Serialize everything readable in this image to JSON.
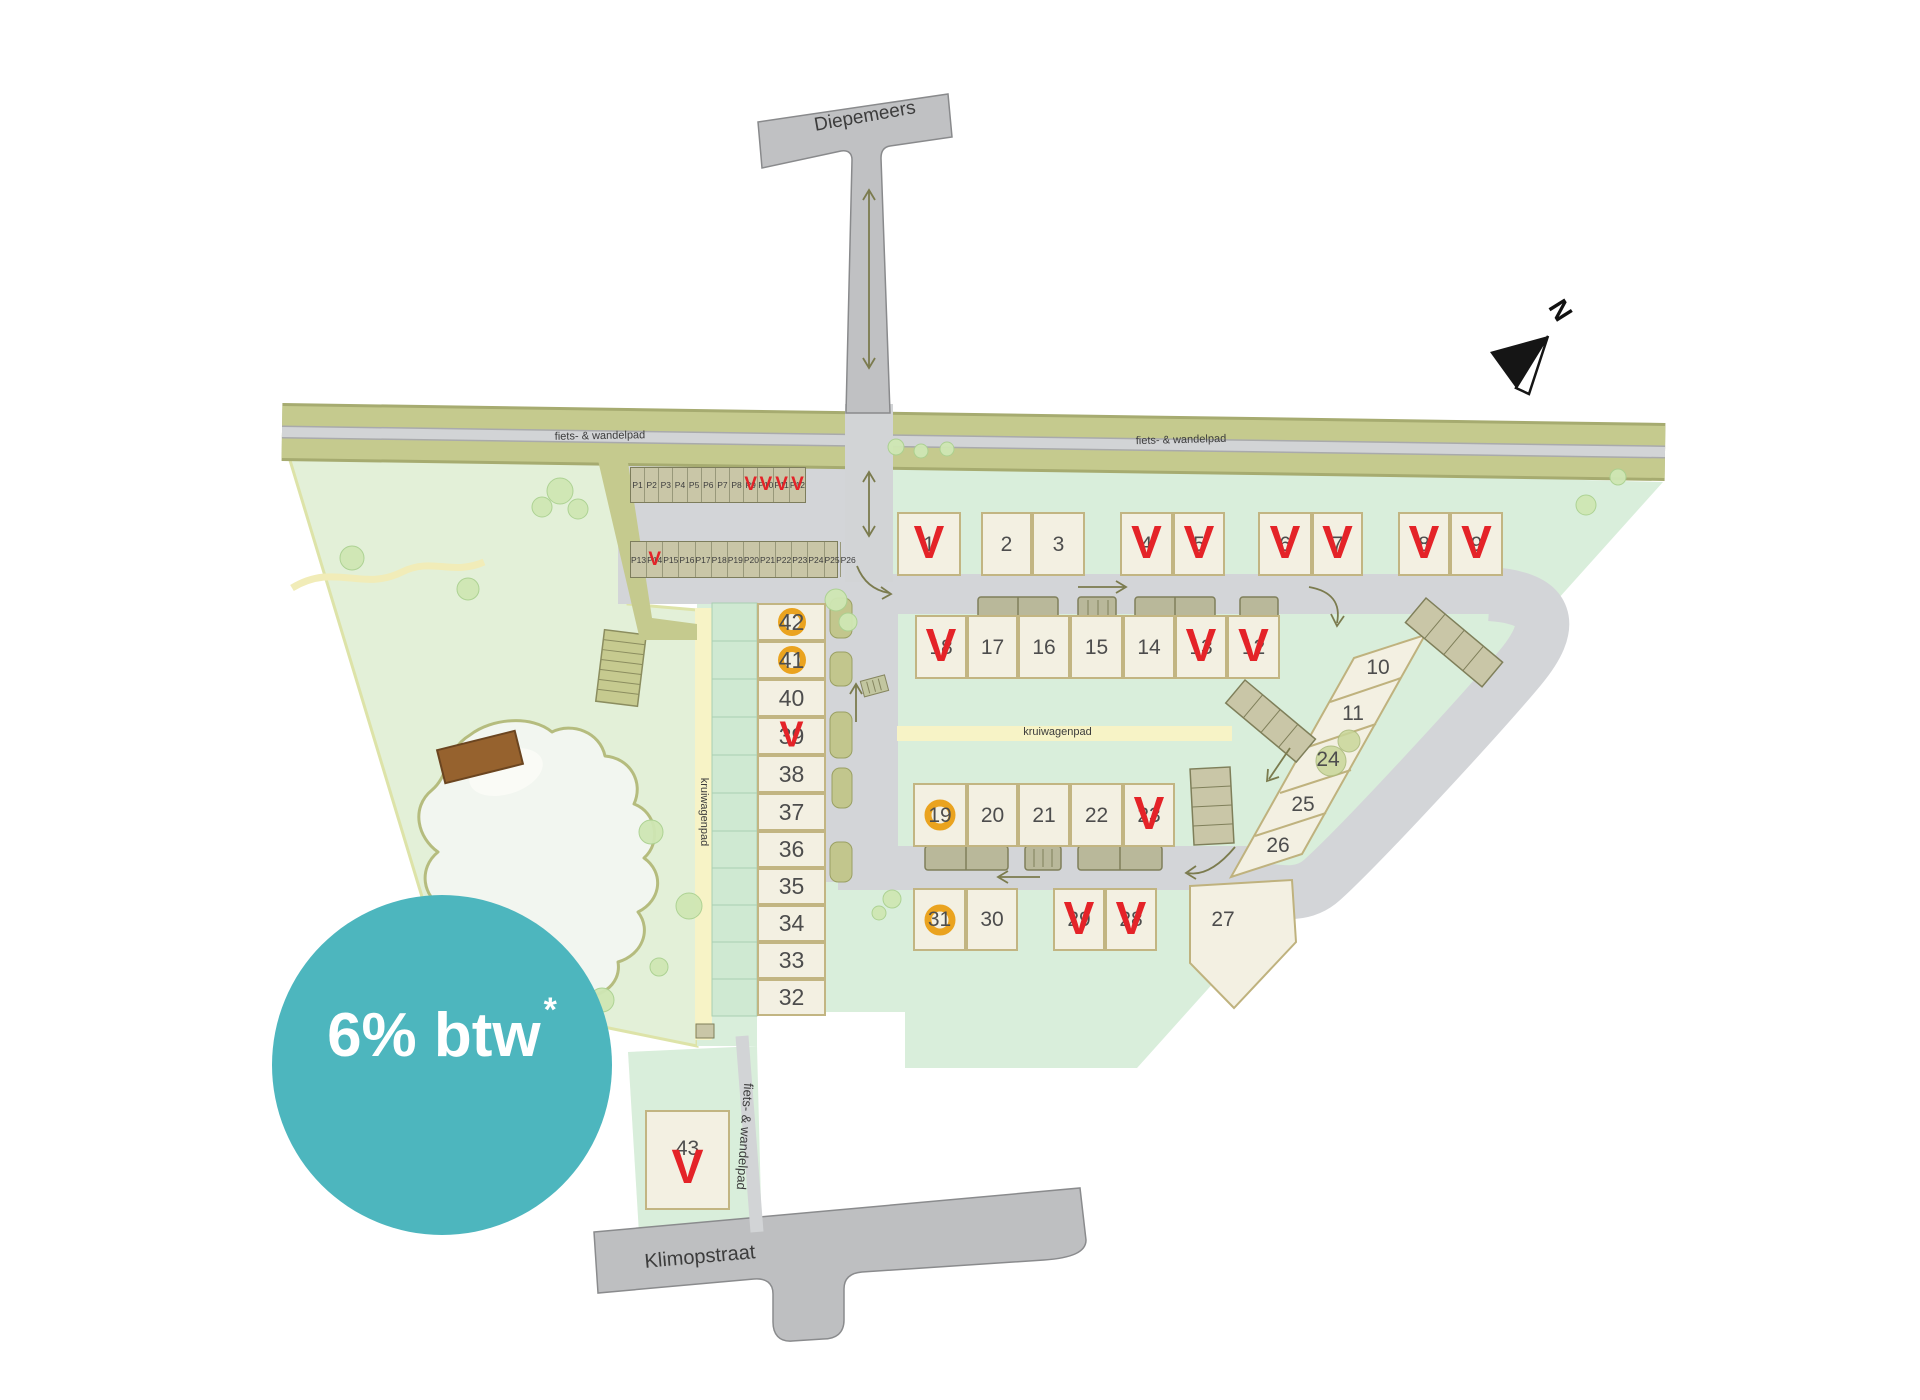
{
  "streets": {
    "diepemeers": "Diepemeers",
    "klimopstraat": "Klimopstraat"
  },
  "path_labels": {
    "bike_left": "fiets- & wandelpad",
    "bike_right": "fiets- & wandelpad",
    "bike_south": "fiets- & wandelpad",
    "barrow_h": "kruiwagenpad",
    "barrow_v": "kruiwagenpad"
  },
  "badge": {
    "text": "6% btw",
    "asterisk": "*",
    "color": "#4db6be"
  },
  "compass": {
    "label": "N"
  },
  "markers": {
    "sold_glyph": "V",
    "sold_color": "#e42328",
    "option_color": "#eaa31f"
  },
  "parking": {
    "row1": [
      {
        "label": "P1",
        "status": "available"
      },
      {
        "label": "P2",
        "status": "available"
      },
      {
        "label": "P3",
        "status": "available"
      },
      {
        "label": "P4",
        "status": "available"
      },
      {
        "label": "P5",
        "status": "available"
      },
      {
        "label": "P6",
        "status": "available"
      },
      {
        "label": "P7",
        "status": "available"
      },
      {
        "label": "P8",
        "status": "available"
      },
      {
        "label": "P9",
        "status": "sold"
      },
      {
        "label": "P10",
        "status": "sold"
      },
      {
        "label": "P11",
        "status": "sold"
      },
      {
        "label": "P12",
        "status": "sold"
      }
    ],
    "row2": [
      {
        "label": "P13",
        "status": "available"
      },
      {
        "label": "P14",
        "status": "sold"
      },
      {
        "label": "P15",
        "status": "available"
      },
      {
        "label": "P16",
        "status": "available"
      },
      {
        "label": "P17",
        "status": "available"
      },
      {
        "label": "P18",
        "status": "available"
      },
      {
        "label": "P19",
        "status": "available"
      },
      {
        "label": "P20",
        "status": "available"
      },
      {
        "label": "P21",
        "status": "available"
      },
      {
        "label": "P22",
        "status": "available"
      },
      {
        "label": "P23",
        "status": "available"
      },
      {
        "label": "P24",
        "status": "available"
      },
      {
        "label": "P25",
        "status": "available"
      },
      {
        "label": "P26",
        "status": "available"
      }
    ]
  },
  "lots": [
    {
      "num": "1",
      "status": "sold",
      "x": 897,
      "y": 512,
      "w": 64,
      "h": 64,
      "cls": ""
    },
    {
      "num": "2",
      "status": "available",
      "x": 981,
      "y": 512,
      "w": 51,
      "h": 64,
      "cls": ""
    },
    {
      "num": "3",
      "status": "available",
      "x": 1032,
      "y": 512,
      "w": 53,
      "h": 64,
      "cls": ""
    },
    {
      "num": "4",
      "status": "sold",
      "x": 1120,
      "y": 512,
      "w": 53,
      "h": 64,
      "cls": ""
    },
    {
      "num": "5",
      "status": "sold",
      "x": 1173,
      "y": 512,
      "w": 52,
      "h": 64,
      "cls": ""
    },
    {
      "num": "6",
      "status": "sold",
      "x": 1258,
      "y": 512,
      "w": 54,
      "h": 64,
      "cls": ""
    },
    {
      "num": "7",
      "status": "sold",
      "x": 1312,
      "y": 512,
      "w": 51,
      "h": 64,
      "cls": ""
    },
    {
      "num": "8",
      "status": "sold",
      "x": 1398,
      "y": 512,
      "w": 52,
      "h": 64,
      "cls": ""
    },
    {
      "num": "9",
      "status": "sold",
      "x": 1450,
      "y": 512,
      "w": 53,
      "h": 64,
      "cls": ""
    },
    {
      "num": "18",
      "status": "sold",
      "x": 915,
      "y": 615,
      "w": 52,
      "h": 64,
      "cls": ""
    },
    {
      "num": "17",
      "status": "available",
      "x": 967,
      "y": 615,
      "w": 51,
      "h": 64,
      "cls": ""
    },
    {
      "num": "16",
      "status": "available",
      "x": 1018,
      "y": 615,
      "w": 52,
      "h": 64,
      "cls": ""
    },
    {
      "num": "15",
      "status": "available",
      "x": 1070,
      "y": 615,
      "w": 53,
      "h": 64,
      "cls": ""
    },
    {
      "num": "14",
      "status": "available",
      "x": 1123,
      "y": 615,
      "w": 52,
      "h": 64,
      "cls": ""
    },
    {
      "num": "13",
      "status": "sold",
      "x": 1175,
      "y": 615,
      "w": 52,
      "h": 64,
      "cls": ""
    },
    {
      "num": "12",
      "status": "sold",
      "x": 1227,
      "y": 615,
      "w": 53,
      "h": 64,
      "cls": ""
    },
    {
      "num": "10",
      "status": "available",
      "x": 1356,
      "y": 647,
      "w": 44,
      "h": 40,
      "cls": "plain"
    },
    {
      "num": "11",
      "status": "available",
      "x": 1331,
      "y": 693,
      "w": 44,
      "h": 40,
      "cls": "plain"
    },
    {
      "num": "24",
      "status": "available",
      "x": 1306,
      "y": 739,
      "w": 44,
      "h": 40,
      "cls": "plain"
    },
    {
      "num": "25",
      "status": "available",
      "x": 1281,
      "y": 784,
      "w": 44,
      "h": 40,
      "cls": "plain"
    },
    {
      "num": "26",
      "status": "available",
      "x": 1256,
      "y": 825,
      "w": 44,
      "h": 40,
      "cls": "plain"
    },
    {
      "num": "19",
      "status": "option",
      "x": 913,
      "y": 783,
      "w": 54,
      "h": 64,
      "cls": ""
    },
    {
      "num": "20",
      "status": "available",
      "x": 967,
      "y": 783,
      "w": 51,
      "h": 64,
      "cls": ""
    },
    {
      "num": "21",
      "status": "available",
      "x": 1018,
      "y": 783,
      "w": 52,
      "h": 64,
      "cls": ""
    },
    {
      "num": "22",
      "status": "available",
      "x": 1070,
      "y": 783,
      "w": 53,
      "h": 64,
      "cls": ""
    },
    {
      "num": "23",
      "status": "sold",
      "x": 1123,
      "y": 783,
      "w": 52,
      "h": 64,
      "cls": ""
    },
    {
      "num": "31",
      "status": "option",
      "x": 913,
      "y": 888,
      "w": 53,
      "h": 63,
      "cls": ""
    },
    {
      "num": "30",
      "status": "available",
      "x": 966,
      "y": 888,
      "w": 52,
      "h": 63,
      "cls": ""
    },
    {
      "num": "29",
      "status": "sold",
      "x": 1053,
      "y": 888,
      "w": 52,
      "h": 63,
      "cls": ""
    },
    {
      "num": "28",
      "status": "sold",
      "x": 1105,
      "y": 888,
      "w": 52,
      "h": 63,
      "cls": ""
    },
    {
      "num": "27",
      "status": "available",
      "x": 1192,
      "y": 896,
      "w": 62,
      "h": 46,
      "cls": "plain"
    },
    {
      "num": "42",
      "status": "option",
      "x": 757,
      "y": 603,
      "w": 69,
      "h": 38,
      "cls": "col"
    },
    {
      "num": "41",
      "status": "option",
      "x": 757,
      "y": 641,
      "w": 69,
      "h": 38,
      "cls": "col"
    },
    {
      "num": "40",
      "status": "available",
      "x": 757,
      "y": 679,
      "w": 69,
      "h": 38,
      "cls": "col"
    },
    {
      "num": "39",
      "status": "sold",
      "x": 757,
      "y": 717,
      "w": 69,
      "h": 38,
      "cls": "col"
    },
    {
      "num": "38",
      "status": "available",
      "x": 757,
      "y": 755,
      "w": 69,
      "h": 38,
      "cls": "col"
    },
    {
      "num": "37",
      "status": "available",
      "x": 757,
      "y": 793,
      "w": 69,
      "h": 38,
      "cls": "col"
    },
    {
      "num": "36",
      "status": "available",
      "x": 757,
      "y": 831,
      "w": 69,
      "h": 37,
      "cls": "col"
    },
    {
      "num": "35",
      "status": "available",
      "x": 757,
      "y": 868,
      "w": 69,
      "h": 37,
      "cls": "col"
    },
    {
      "num": "34",
      "status": "available",
      "x": 757,
      "y": 905,
      "w": 69,
      "h": 37,
      "cls": "col"
    },
    {
      "num": "33",
      "status": "available",
      "x": 757,
      "y": 942,
      "w": 69,
      "h": 37,
      "cls": "col"
    },
    {
      "num": "32",
      "status": "available",
      "x": 757,
      "y": 979,
      "w": 69,
      "h": 37,
      "cls": "col"
    },
    {
      "num": "43",
      "status": "sold",
      "x": 645,
      "y": 1110,
      "w": 85,
      "h": 100,
      "cls": "tall"
    }
  ]
}
